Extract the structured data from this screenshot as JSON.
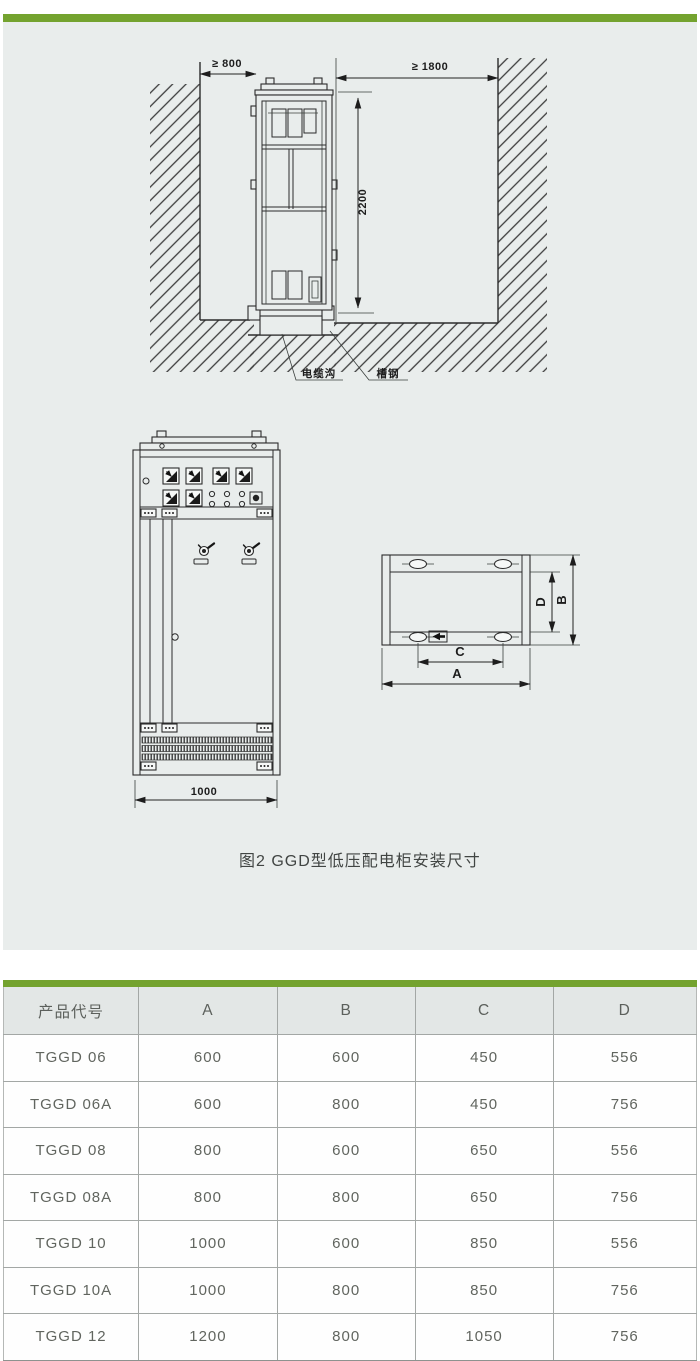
{
  "page": {
    "accent_color": "#74a32f",
    "panel_bg": "#e9edec"
  },
  "figure": {
    "caption": "图2 GGD型低压配电柜安装尺寸",
    "side_view": {
      "left_clearance": "≥ 800",
      "right_clearance": "≥ 1800",
      "cabinet_height": "2200",
      "cable_trench_label": "电缆沟",
      "channel_steel_label": "槽钢"
    },
    "front_view": {
      "cabinet_width": "1000"
    },
    "top_view": {
      "dim_a": "A",
      "dim_b": "B",
      "dim_c": "C",
      "dim_d": "D"
    }
  },
  "table": {
    "headers": [
      "产品代号",
      "A",
      "B",
      "C",
      "D"
    ],
    "rows": [
      [
        "TGGD 06",
        "600",
        "600",
        "450",
        "556"
      ],
      [
        "TGGD 06A",
        "600",
        "800",
        "450",
        "756"
      ],
      [
        "TGGD 08",
        "800",
        "600",
        "650",
        "556"
      ],
      [
        "TGGD 08A",
        "800",
        "800",
        "650",
        "756"
      ],
      [
        "TGGD 10",
        "1000",
        "600",
        "850",
        "556"
      ],
      [
        "TGGD 10A",
        "1000",
        "800",
        "850",
        "756"
      ],
      [
        "TGGD 12",
        "1200",
        "800",
        "1050",
        "756"
      ]
    ]
  }
}
